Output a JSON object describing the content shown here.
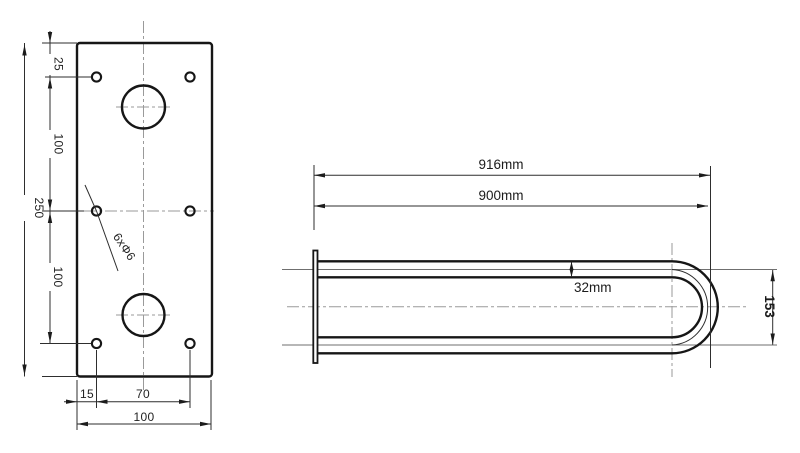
{
  "drawing": {
    "front_view": {
      "dim_top_offset": "25",
      "dim_upper_spacing": "100",
      "dim_overall_height": "250",
      "dim_lower_spacing": "100",
      "dim_edge_offset": "15",
      "dim_hole_span": "70",
      "dim_plate_width": "100",
      "holes_note": "6xΦ6"
    },
    "side_view": {
      "dim_overall_length": "916mm",
      "dim_bar_length": "900mm",
      "dim_tube_diameter": "32mm",
      "dim_end_height": "153"
    },
    "colors": {
      "line": "#161616",
      "dimension": "#2e2e2e",
      "centerline": "#9a9a9a"
    }
  }
}
